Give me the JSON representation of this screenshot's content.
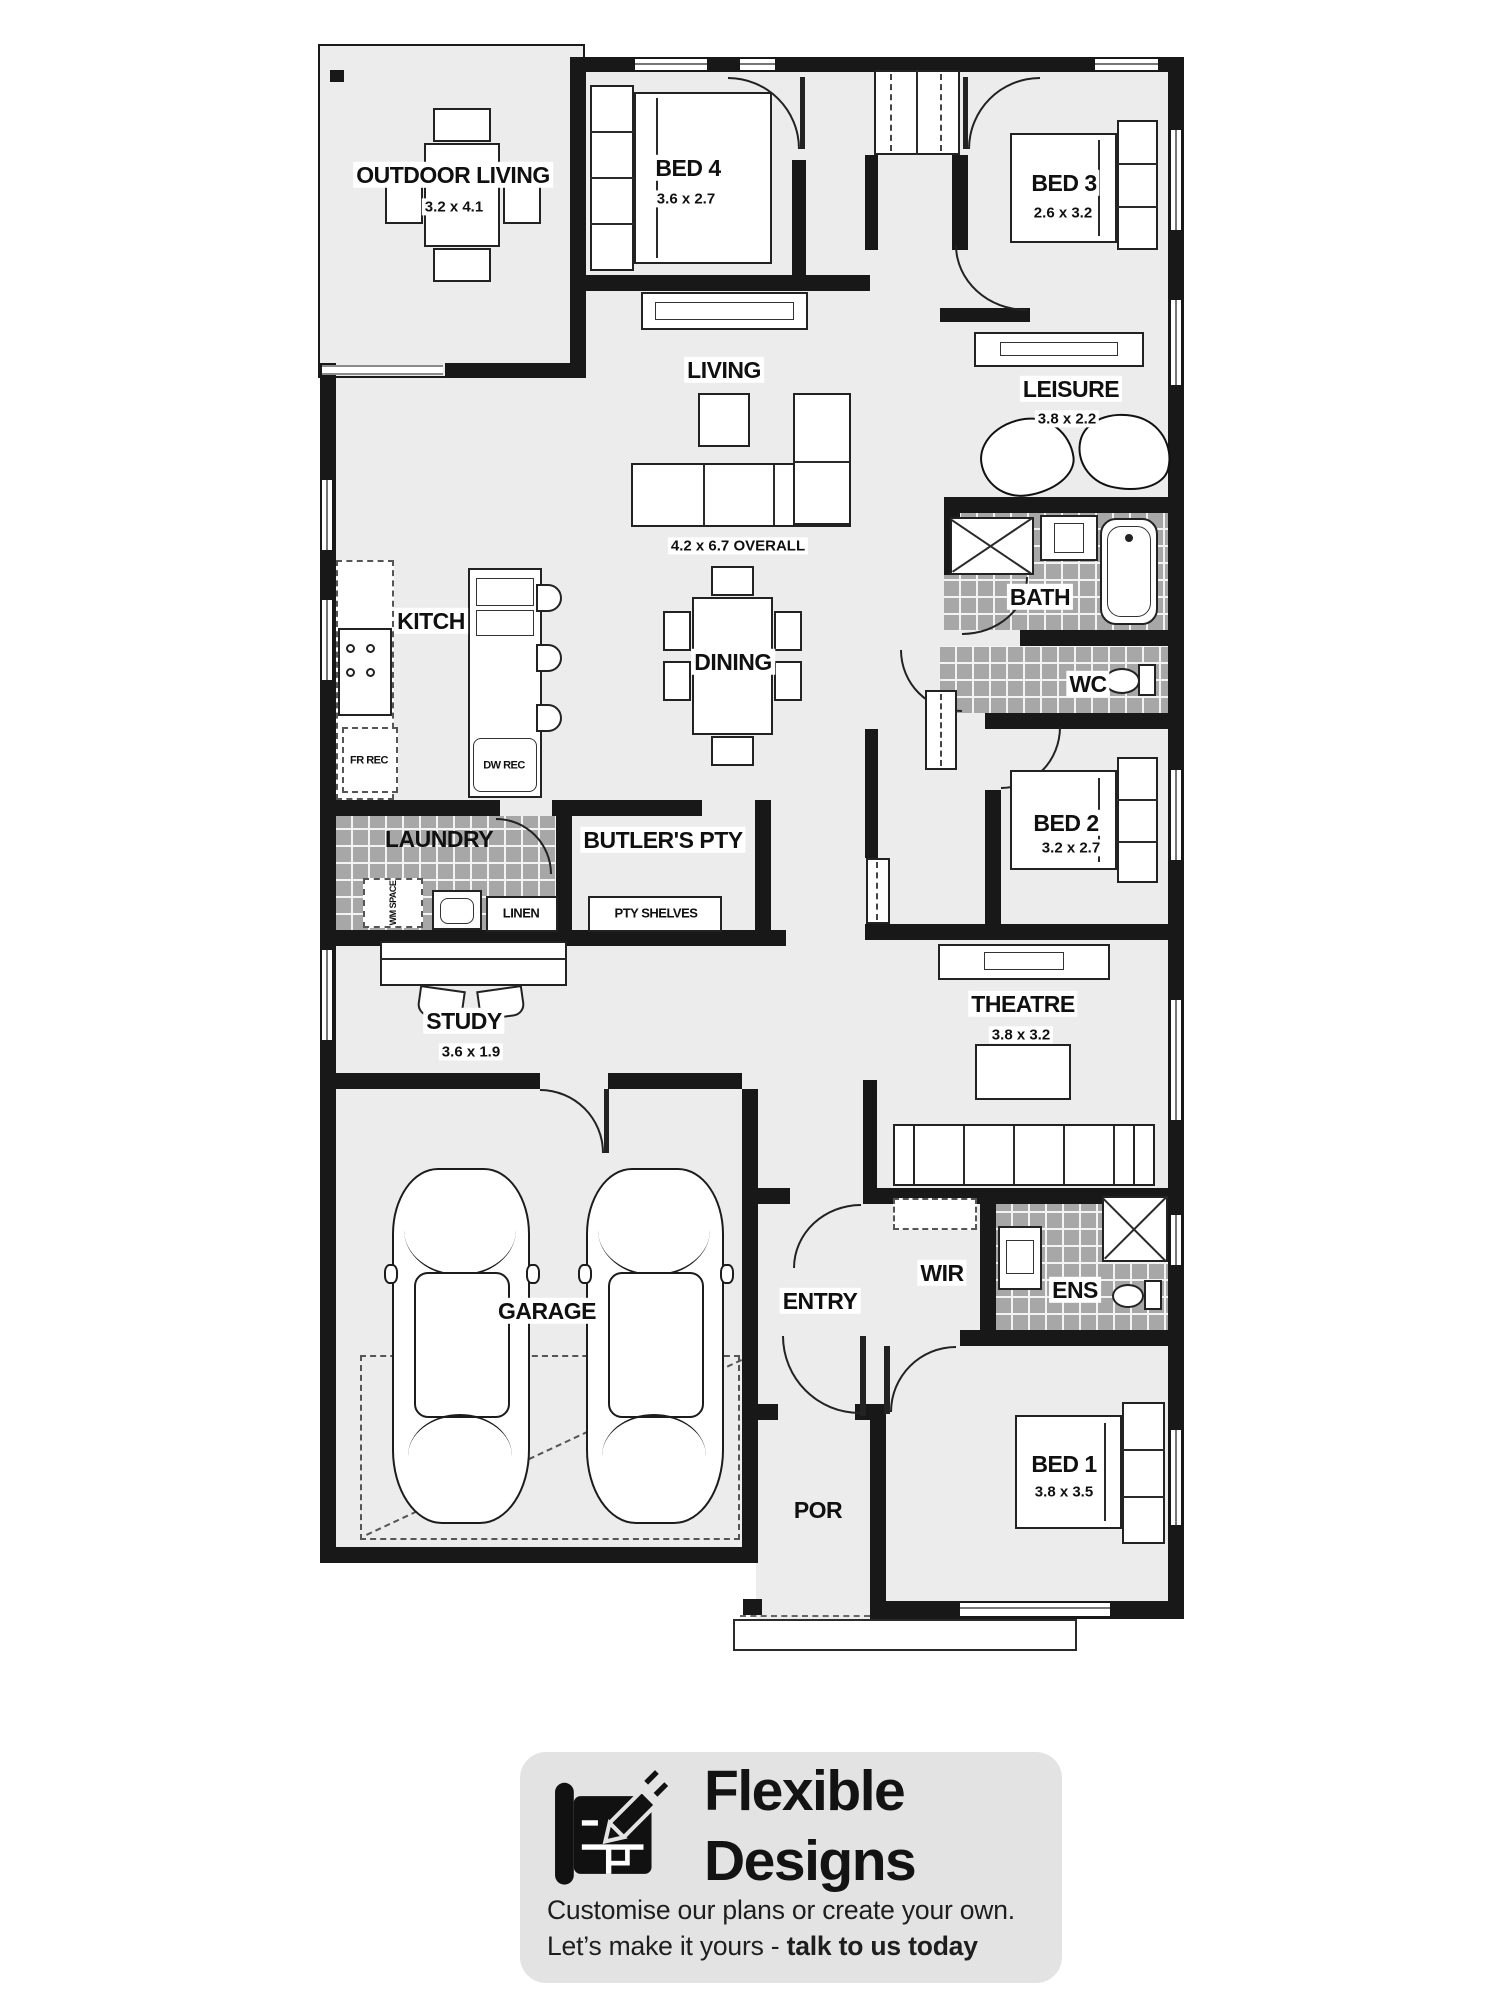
{
  "plan": {
    "rooms": {
      "outdoor_living": {
        "label": "OUTDOOR LIVING",
        "dims": "3.2 x 4.1"
      },
      "bed4": {
        "label": "BED 4",
        "dims": "3.6 x 2.7"
      },
      "bed3": {
        "label": "BED 3",
        "dims": "2.6 x 3.2"
      },
      "living": {
        "label": "LIVING",
        "dims": "4.2 x 6.7 OVERALL"
      },
      "leisure": {
        "label": "LEISURE",
        "dims": "3.8 x 2.2"
      },
      "bath": {
        "label": "BATH"
      },
      "wc": {
        "label": "WC"
      },
      "kitchen": {
        "label": "KITCH"
      },
      "dining": {
        "label": "DINING"
      },
      "bed2": {
        "label": "BED 2",
        "dims": "3.2 x 2.7"
      },
      "laundry": {
        "label": "LAUNDRY"
      },
      "linen": {
        "label": "LINEN"
      },
      "butlers_pty": {
        "label": "BUTLER'S PTY"
      },
      "pty_shelves": {
        "label": "PTY SHELVES"
      },
      "study": {
        "label": "STUDY",
        "dims": "3.6 x 1.9"
      },
      "theatre": {
        "label": "THEATRE",
        "dims": "3.8 x 3.2"
      },
      "garage": {
        "label": "GARAGE"
      },
      "entry": {
        "label": "ENTRY"
      },
      "wir": {
        "label": "WIR"
      },
      "ens": {
        "label": "ENS"
      },
      "bed1": {
        "label": "BED 1",
        "dims": "3.8 x 3.5"
      },
      "porch": {
        "label": "POR"
      }
    },
    "annotations": {
      "dw_rec": "DW REC",
      "fr_rec": "FR REC",
      "wm_space": "WM SPACE"
    },
    "colors": {
      "floor": "#ececec",
      "wall": "#181818",
      "tile": "#a7a7a7",
      "card": "#e3e3e3"
    }
  },
  "footer": {
    "brand_line1": "Flexible",
    "brand_line2": "Designs",
    "tagline": "Customise our plans or create your own.",
    "cta_prefix": "Let’s make it yours - ",
    "cta_bold": "talk to us today"
  }
}
